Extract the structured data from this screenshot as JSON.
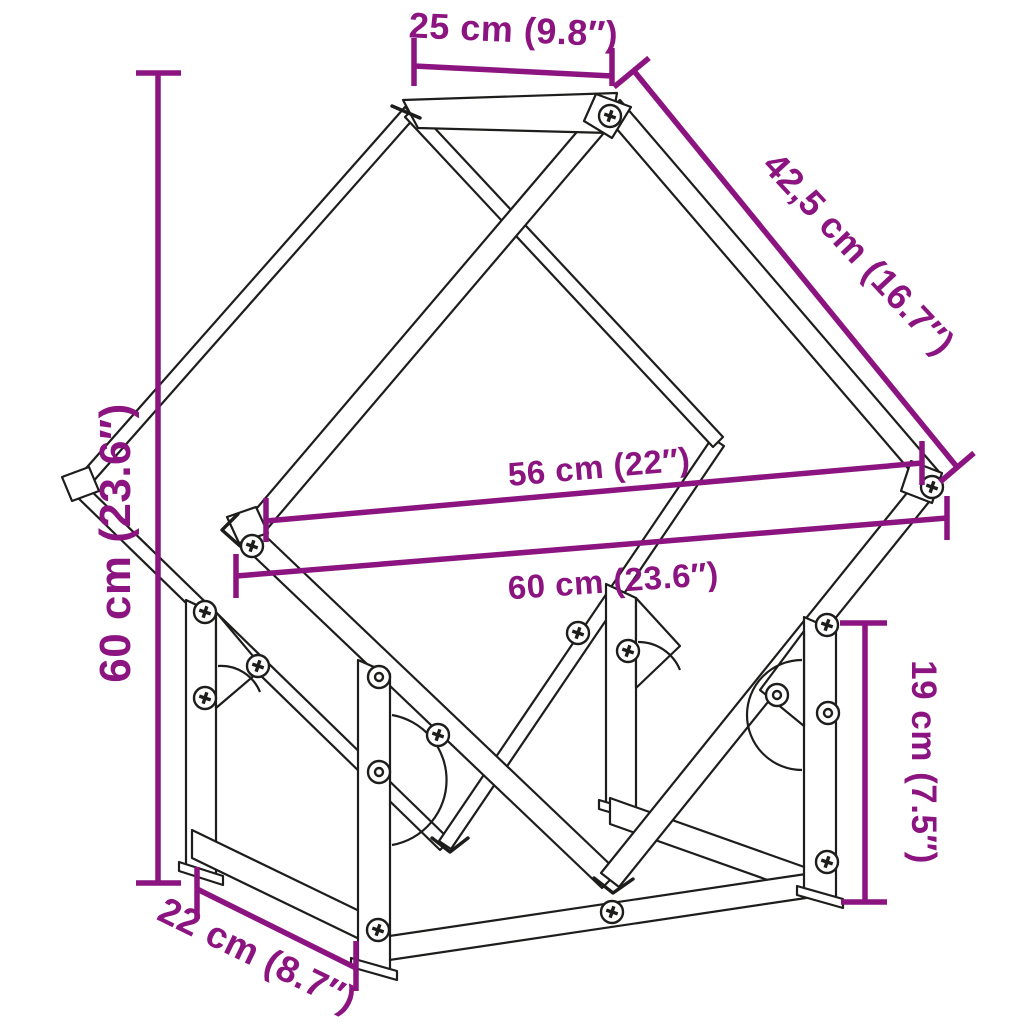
{
  "diagram": {
    "accent_color": "#8B1480",
    "line_color": "#1D1D1B",
    "background_color": "#FFFFFF",
    "dimensions": [
      {
        "id": "top-depth",
        "label": "25 cm (9.8″)"
      },
      {
        "id": "slanted-side",
        "label": "42,5 cm (16.7″)"
      },
      {
        "id": "overall-height",
        "label": "60 cm (23.6″)"
      },
      {
        "id": "inner-width",
        "label": "56 cm (22″)"
      },
      {
        "id": "overall-width",
        "label": "60 cm (23.6″)"
      },
      {
        "id": "leg-height",
        "label": "19 cm (7.5″)"
      },
      {
        "id": "base-depth",
        "label": "22 cm (8.7″)"
      }
    ],
    "icons": {
      "phillips_screw": "phillips-screw-icon",
      "ring_screw": "ring-screw-icon"
    }
  }
}
